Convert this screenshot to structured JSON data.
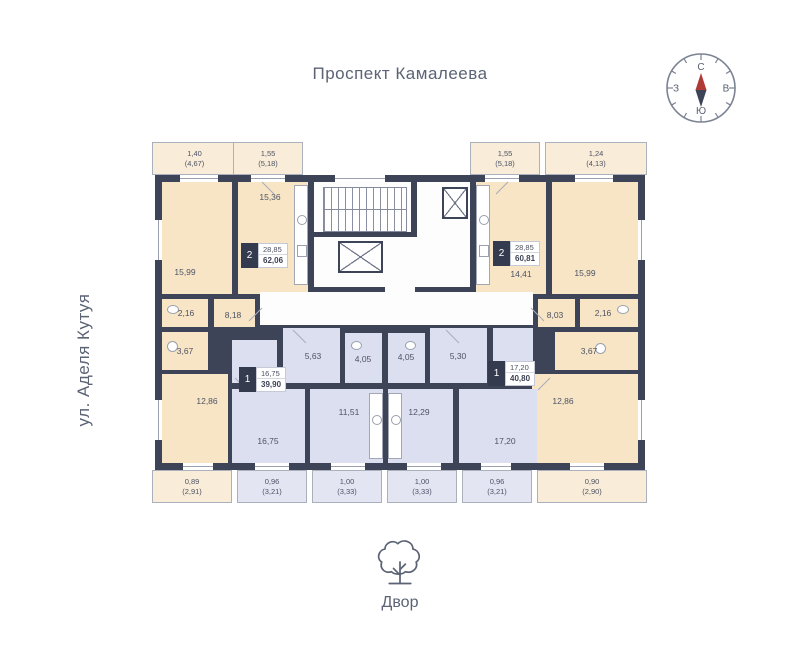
{
  "texts": {
    "street_top": "Проспект Камалеева",
    "street_left": "ул. Аделя Кутуя",
    "yard_label": "Двор"
  },
  "compass": {
    "north": "С",
    "south": "Ю",
    "west": "З",
    "east": "В"
  },
  "apartments": {
    "left_2room": {
      "badge": "2",
      "living_area": "28,85",
      "total_area": "62,06",
      "rooms": {
        "room_a": "15,99",
        "kitchen": "15,36",
        "wc": "2,16",
        "bath": "3,67",
        "hall": "8,18",
        "room_b": "12,86"
      }
    },
    "right_2room": {
      "badge": "2",
      "living_area": "28,85",
      "total_area": "60,81",
      "rooms": {
        "kitchen": "14,41",
        "room_a": "15,99",
        "wc": "2,16",
        "bath": "3,67",
        "hall": "8,03",
        "room_b": "12,86"
      }
    },
    "bottom_left_1room": {
      "badge": "1",
      "living_area": "16,75",
      "total_area": "39,90",
      "rooms": {
        "hall": "5,63",
        "bath": "4,05",
        "living": "16,75",
        "kitchen": "11,51"
      }
    },
    "bottom_right_1room": {
      "badge": "1",
      "living_area": "17,20",
      "total_area": "40,80",
      "rooms": {
        "hall": "5,30",
        "bath": "4,05",
        "kitchen": "12,29",
        "living": "17,20"
      }
    }
  },
  "balconies": {
    "top": [
      {
        "area": "1,40",
        "total": "(4,67)"
      },
      {
        "area": "1,55",
        "total": "(5,18)"
      },
      {
        "area": "1,55",
        "total": "(5,18)"
      },
      {
        "area": "1,24",
        "total": "(4,13)"
      }
    ],
    "bottom": [
      {
        "area": "0,89",
        "total": "(2,91)"
      },
      {
        "area": "0,96",
        "total": "(3,21)"
      },
      {
        "area": "1,00",
        "total": "(3,33)"
      },
      {
        "area": "1,00",
        "total": "(3,33)"
      },
      {
        "area": "0,96",
        "total": "(3,21)"
      },
      {
        "area": "0,90",
        "total": "(2,90)"
      }
    ]
  },
  "colors": {
    "wall": "#3e4457",
    "beige": "#f7e5c6",
    "lavender": "#dcdff0",
    "needle_red": "#b03a35"
  }
}
